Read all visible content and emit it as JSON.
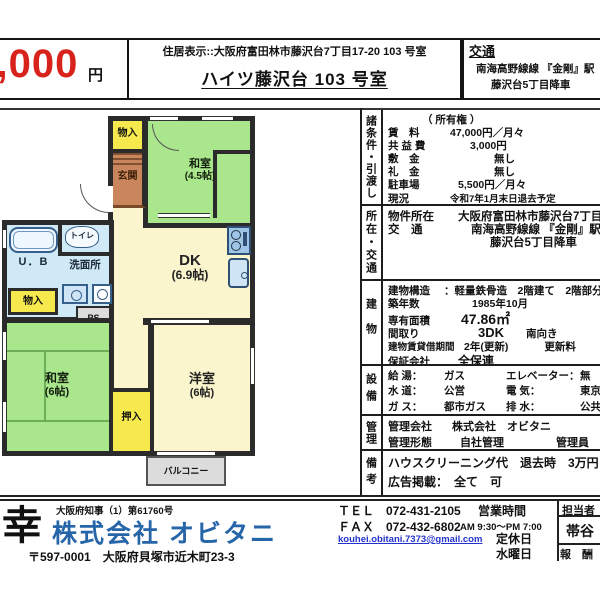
{
  "header": {
    "price_value": "47,000",
    "price_unit": "円",
    "address_line": "住居表示::大阪府富田林市藤沢台7丁目17-20 103 号室",
    "building_name": "ハイツ藤沢台 103 号室",
    "access_title": "交通",
    "access_line1": "南海高野線線 『金剛』駅",
    "access_line2": "藤沢台5丁目降車"
  },
  "floorplan": {
    "storage_top": "物入",
    "entrance": "玄関",
    "tatami45_name": "和室",
    "tatami45_size": "(4.5帖)",
    "dk_name": "DK",
    "dk_size": "(6.9帖)",
    "toilet": "トイレ",
    "unit_bath": "U．B",
    "washroom": "洗面所",
    "storage_left": "物入",
    "pipe_space": "PS",
    "tatami6_name": "和室",
    "tatami6_size": "(6帖)",
    "closet": "押入",
    "western_name": "洋室",
    "western_size": "(6帖)",
    "balcony": "バルコニー"
  },
  "table": {
    "sections": [
      {
        "label": "諸条件・引渡し",
        "rows": [
          {
            "label": "",
            "value": "（ 所有権 ）"
          },
          {
            "label": "賃　料",
            "value": "47,000円／月々"
          },
          {
            "label": "共 益 費",
            "value": "3,000円"
          },
          {
            "label": "敷　金",
            "value": "無し"
          },
          {
            "label": "礼　金",
            "value": "無し"
          },
          {
            "label": "駐車場",
            "value": "5,500円／月々"
          },
          {
            "label": "現況",
            "value": "令和7年1月末日退去予定"
          }
        ]
      },
      {
        "label": "所在・交通",
        "rows": [
          {
            "label": "物件所在",
            "value": "大阪府富田林市藤沢台7丁目"
          },
          {
            "label": "交　通",
            "value": "南海高野線線 『金剛』駅"
          },
          {
            "label": "",
            "value": "藤沢台5丁目降車"
          }
        ]
      },
      {
        "label": "建物",
        "rows": [
          {
            "label": "建物構造",
            "value": "：軽量鉄骨造　2階建て　2階部分"
          },
          {
            "label": "築年数",
            "value": "1985年10月"
          },
          {
            "label": "専有面積",
            "value": "47.86㎡"
          },
          {
            "label": "間取り",
            "value": "3DK",
            "extra": "南向き"
          },
          {
            "label": "建物賃貸借期間",
            "value": "2年(更新)",
            "extra": "更新料"
          },
          {
            "label": "保証会社",
            "value": "全保連"
          }
        ]
      },
      {
        "label": "設備",
        "rows": [
          {
            "label": "給 湯：",
            "value": "ガス",
            "label2": "エレベーター：",
            "value2": "無"
          },
          {
            "label": "水 道：",
            "value": "公営",
            "label2": "電 気：",
            "value2": "東京電力"
          },
          {
            "label": "ガ ス：",
            "value": "都市ガス",
            "label2": "排 水：",
            "value2": "公共下水"
          }
        ]
      },
      {
        "label": "管理",
        "rows": [
          {
            "label": "管理会社",
            "value": "株式会社　オビタニ"
          },
          {
            "label": "管理形態",
            "value": "自社管理",
            "extra": "管理員"
          }
        ]
      },
      {
        "label": "備考",
        "rows": [
          {
            "label": "",
            "value": "ハウスクリーニング代　退去時　3万円"
          },
          {
            "label": "広告掲載：",
            "value": "全て　可"
          }
        ]
      }
    ]
  },
  "footer": {
    "license": "大阪府知事（1）第61760号",
    "logo": "幸",
    "company": "株式会社 オビタニ",
    "postal_address": "〒597-0001　大阪府貝塚市近木町23-3",
    "tel": "ＴＥＬ　072-431-2105",
    "fax": "ＦＡＸ　072-432-6802",
    "email": "kouhei.obitani.7373@gmail.com",
    "hours_label": "営業時間",
    "hours_value": "AM 9:30～PM 7:00",
    "holiday_label": "定休日",
    "holiday_value": "水曜日",
    "staff_label": "担当者",
    "staff_name": "帯谷",
    "fee_label": "報　酬"
  }
}
